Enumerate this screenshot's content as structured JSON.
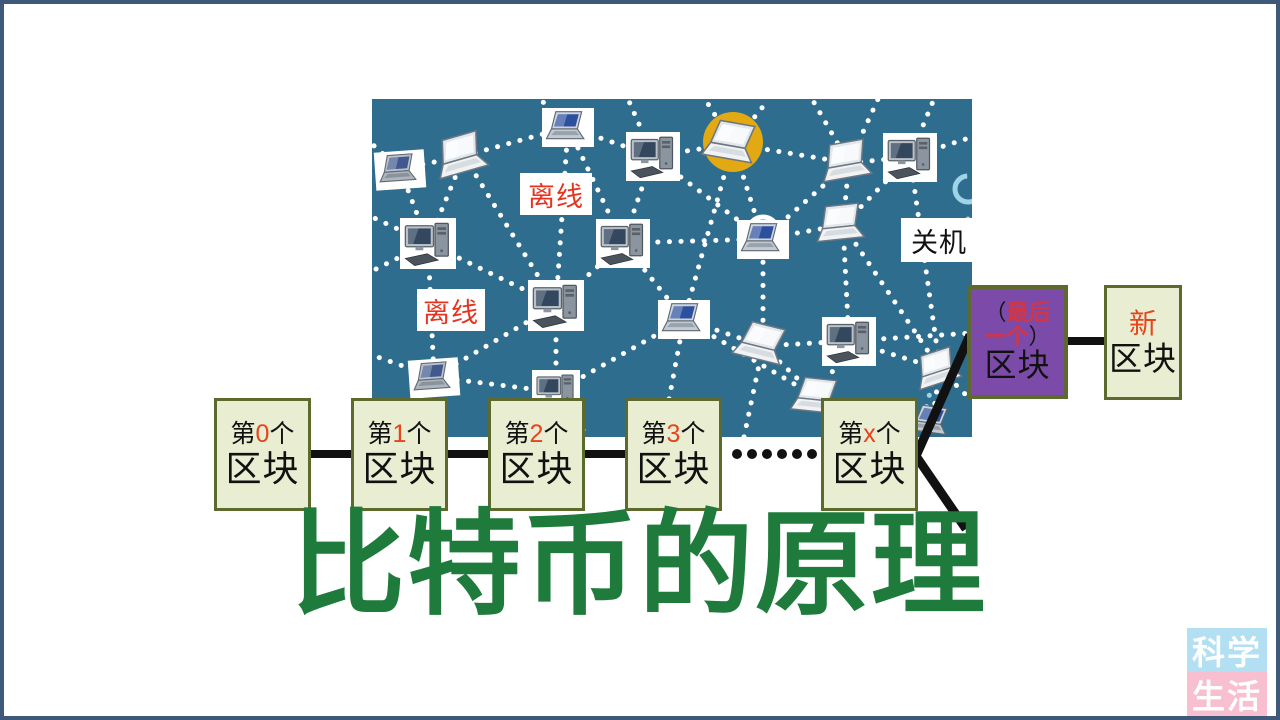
{
  "title": {
    "text": "比特币的原理"
  },
  "colors": {
    "frame": "#3e5a78",
    "panel": "#2f6d8e",
    "dot": "#ffffff",
    "accent": "#9fd4e8",
    "ink": "#111111",
    "title": "#1e7b3b",
    "numred": "#e8431c",
    "labelred": "#e63320",
    "hlred": "#d23646",
    "blockfill": "#e9edd2",
    "blockborder": "#5c6a2d",
    "purple": "#7c4aa8",
    "halo": "#e2a912",
    "wmblue": "#b3dff2",
    "wmpink": "#f7bfcf"
  },
  "network": {
    "panel": {
      "x": 368,
      "y": 95,
      "width": 600,
      "height": 338
    },
    "labels": [
      {
        "id": "offline-1",
        "text": "离线",
        "color": "labelred",
        "x": 148,
        "y": 74,
        "w": 72,
        "h": 42
      },
      {
        "id": "offline-2",
        "text": "离线",
        "color": "labelred",
        "x": 45,
        "y": 190,
        "w": 68,
        "h": 42
      },
      {
        "id": "shutdown",
        "text": "关机",
        "color": "ink",
        "x": 529,
        "y": 119,
        "w": 76,
        "h": 44
      }
    ],
    "nodes": [
      {
        "x": 28,
        "y": 70,
        "t": "laptop",
        "v": "gray",
        "box": true,
        "rot": -4,
        "s": 50
      },
      {
        "x": 92,
        "y": 57,
        "t": "laptop",
        "v": "white",
        "rot": -16,
        "s": 62
      },
      {
        "x": 196,
        "y": 28,
        "t": "laptop",
        "v": "blue",
        "box": true,
        "s": 52
      },
      {
        "x": 281,
        "y": 57,
        "t": "desktop",
        "box": true,
        "s": 54
      },
      {
        "x": 361,
        "y": 45,
        "t": "laptop",
        "v": "white",
        "rot": 10,
        "s": 62,
        "halo": true
      },
      {
        "x": 477,
        "y": 64,
        "t": "laptop",
        "v": "white",
        "rot": -10,
        "s": 60
      },
      {
        "x": 538,
        "y": 58,
        "t": "desktop",
        "box": true,
        "s": 54
      },
      {
        "x": 56,
        "y": 144,
        "t": "desktop",
        "box": true,
        "s": 56
      },
      {
        "x": 251,
        "y": 144,
        "t": "desktop",
        "box": true,
        "s": 54
      },
      {
        "x": 391,
        "y": 140,
        "t": "laptop",
        "v": "blue",
        "box": true,
        "s": 52
      },
      {
        "x": 471,
        "y": 126,
        "t": "laptop",
        "v": "white",
        "rot": -6,
        "s": 58
      },
      {
        "x": 184,
        "y": 206,
        "t": "desktop",
        "box": true,
        "s": 56
      },
      {
        "x": 312,
        "y": 220,
        "t": "laptop",
        "v": "blue",
        "box": true,
        "s": 52
      },
      {
        "x": 391,
        "y": 247,
        "t": "laptop",
        "v": "white",
        "rot": 14,
        "s": 60
      },
      {
        "x": 477,
        "y": 242,
        "t": "desktop",
        "box": true,
        "s": 54
      },
      {
        "x": 62,
        "y": 278,
        "t": "laptop",
        "v": "gray",
        "box": true,
        "rot": -4,
        "s": 50
      },
      {
        "x": 184,
        "y": 293,
        "t": "desktop",
        "box": true,
        "s": 48
      },
      {
        "x": 446,
        "y": 299,
        "t": "laptop",
        "v": "white",
        "rot": 6,
        "s": 56
      },
      {
        "x": 568,
        "y": 270,
        "t": "laptop",
        "v": "white",
        "rot": -18,
        "s": 54
      },
      {
        "x": 560,
        "y": 323,
        "t": "laptop",
        "v": "blue",
        "rot": 8,
        "s": 44
      }
    ],
    "edges": [
      [
        0,
        1
      ],
      [
        1,
        2
      ],
      [
        2,
        3
      ],
      [
        3,
        4
      ],
      [
        4,
        5
      ],
      [
        5,
        6
      ],
      [
        0,
        7
      ],
      [
        1,
        7
      ],
      [
        1,
        11
      ],
      [
        2,
        8
      ],
      [
        2,
        11
      ],
      [
        3,
        8
      ],
      [
        3,
        9
      ],
      [
        4,
        9
      ],
      [
        4,
        12
      ],
      [
        5,
        9
      ],
      [
        5,
        10
      ],
      [
        6,
        10
      ],
      [
        6,
        18
      ],
      [
        7,
        11
      ],
      [
        7,
        15
      ],
      [
        8,
        9
      ],
      [
        8,
        11
      ],
      [
        8,
        12
      ],
      [
        9,
        10
      ],
      [
        9,
        13
      ],
      [
        10,
        14
      ],
      [
        10,
        18
      ],
      [
        11,
        15
      ],
      [
        11,
        16
      ],
      [
        12,
        13
      ],
      [
        12,
        16
      ],
      [
        12,
        17
      ],
      [
        13,
        14
      ],
      [
        13,
        17
      ],
      [
        14,
        17
      ],
      [
        14,
        18
      ],
      [
        15,
        16
      ],
      [
        17,
        19
      ],
      [
        18,
        19
      ]
    ],
    "stubs": [
      [
        28,
        70,
        0,
        45
      ],
      [
        56,
        144,
        0,
        118
      ],
      [
        56,
        144,
        0,
        172
      ],
      [
        62,
        278,
        0,
        256
      ],
      [
        62,
        278,
        22,
        338
      ],
      [
        184,
        293,
        158,
        338
      ],
      [
        184,
        293,
        216,
        338
      ],
      [
        196,
        28,
        168,
        0
      ],
      [
        281,
        57,
        256,
        0
      ],
      [
        361,
        45,
        333,
        0
      ],
      [
        361,
        45,
        397,
        0
      ],
      [
        477,
        64,
        440,
        0
      ],
      [
        477,
        64,
        506,
        0
      ],
      [
        538,
        58,
        562,
        0
      ],
      [
        538,
        58,
        600,
        38
      ],
      [
        477,
        242,
        600,
        234
      ],
      [
        568,
        270,
        600,
        302
      ],
      [
        446,
        299,
        470,
        338
      ],
      [
        312,
        220,
        290,
        338
      ],
      [
        391,
        247,
        372,
        338
      ]
    ],
    "accent_stubs": [
      [
        560,
        285,
        548,
        335
      ],
      [
        596,
        120,
        584,
        160
      ]
    ],
    "arcs": [
      {
        "x": 391,
        "y": 133,
        "r": 15,
        "color": "dot",
        "kind": "top-half"
      },
      {
        "x": 596,
        "y": 90,
        "r": 13,
        "color": "accent",
        "kind": "ring"
      }
    ]
  },
  "chain": {
    "blocks": [
      {
        "prefix": "第",
        "num": "0",
        "suffix": "个",
        "name": "区块"
      },
      {
        "prefix": "第",
        "num": "1",
        "suffix": "个",
        "name": "区块"
      },
      {
        "prefix": "第",
        "num": "2",
        "suffix": "个",
        "name": "区块"
      },
      {
        "prefix": "第",
        "num": "3",
        "suffix": "个",
        "name": "区块"
      },
      {
        "prefix": "第",
        "num": "x",
        "suffix": "个",
        "name": "区块"
      }
    ],
    "ellipsis_dots": 6,
    "last_block": {
      "open": "（",
      "hl1": "最后",
      "hl2": "一个",
      "close": "）",
      "name": "区块"
    },
    "new_block": {
      "hl": "新",
      "name": "区块"
    }
  },
  "watermark": {
    "rows": [
      {
        "text": "科学",
        "bg": "wmblue"
      },
      {
        "text": "生活",
        "bg": "wmpink"
      }
    ]
  }
}
